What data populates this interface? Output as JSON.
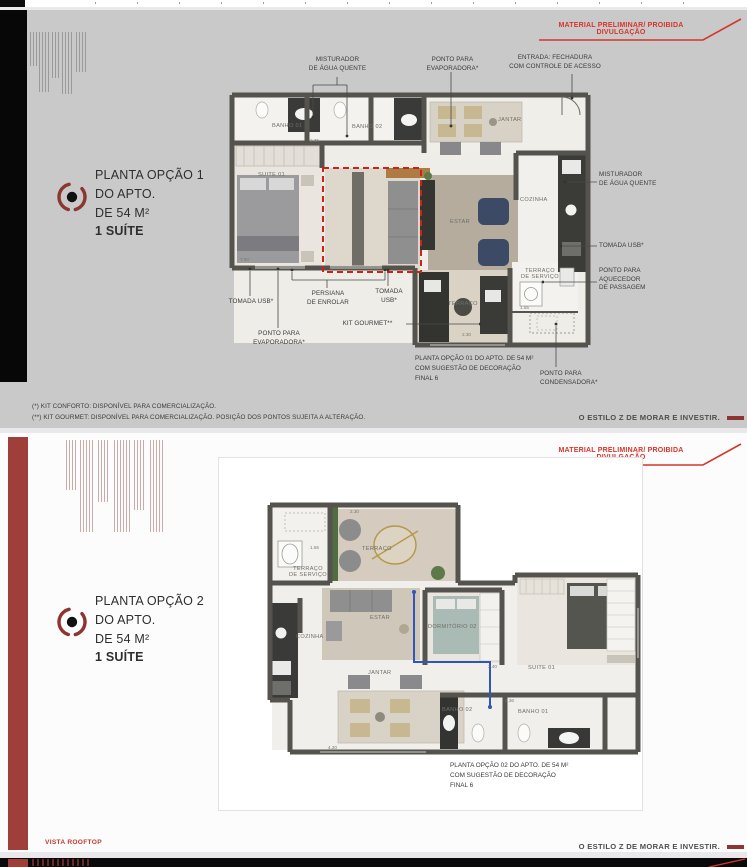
{
  "banner": "MATERIAL PRELIMINAR/ PROIBIDA DIVULGAÇÃO",
  "tagline": "O ESTILO Z DE MORAR E INVESTIR.",
  "colors": {
    "accent": "#8c3531",
    "banner_red": "#d6352c",
    "page1_bg": "#c9c9c9",
    "dashed_red": "#cc2218",
    "pipe_blue": "#3056b8"
  },
  "page1": {
    "title": {
      "l1": "PLANTA OPÇÃO 1",
      "l2": "DO APTO.",
      "l3": "DE 54 M²",
      "l4": "1 SUÍTE"
    },
    "rooms": {
      "suite": "SUITE 01",
      "banho1": "BANHO 01",
      "banho2": "BANHO 02",
      "jantar": "JANTAR",
      "estar": "ESTAR",
      "cozinha": "COZINHA",
      "terraco": "TERRAÇO",
      "terraco_servico": "TERRAÇO\nDE SERVIÇO"
    },
    "callouts": {
      "misturador_top": "MISTURADOR\nDE ÁGUA QUENTE",
      "evaporadora_top": "PONTO PARA\nEVAPORADORA*",
      "entrada": "ENTRADA: FECHADURA\nCOM CONTROLE DE ACESSO",
      "misturador_right": "MISTURADOR\nDE ÁGUA QUENTE",
      "tomada_right": "TOMADA USB*",
      "aquecedor": "PONTO PARA\nAQUECEDOR\nDE PASSAGEM",
      "tomada_bottom_left": "TOMADA USB*",
      "persiana": "PERSIANA\nDE ENROLAR",
      "tomada_bottom_center": "TOMADA\nUSB*",
      "kit_gourmet": "KIT GOURMET**",
      "evaporadora_bottom": "PONTO PARA\nEVAPORADORA*",
      "condensadora": "PONTO PARA\nCONDENSADORA*"
    },
    "caption": "PLANTA OPÇÃO 01 DO APTO. DE 54 M²\nCOM SUGESTÃO DE DECORAÇÃO\nFINAL 6",
    "footnote1": "(*) KIT CONFORTO: DISPONÍVEL PARA COMERCIALIZAÇÃO.",
    "footnote2": "(**) KIT GOURMET: DISPONÍVEL PARA COMERCIALIZAÇÃO. POSIÇÃO DOS PONTOS SUJEITA A ALTERAÇÃO.",
    "dims": [
      "2.36",
      "2.30",
      "1.55",
      "7.90"
    ]
  },
  "page2": {
    "title": {
      "l1": "PLANTA OPÇÃO 2",
      "l2": "DO APTO.",
      "l3": "DE 54 M²",
      "l4": "1 SUÍTE"
    },
    "rooms": {
      "terraco": "TERRAÇO",
      "terraco_servico": "TERRAÇO\nDE SERVIÇO",
      "estar": "ESTAR",
      "dormitorio2": "DORMITÓRIO 02",
      "cozinha": "COZINHA",
      "jantar": "JANTAR",
      "suite": "SUITE 01",
      "banho2": "BANHO 02",
      "banho1": "BANHO 01"
    },
    "caption": "PLANTA OPÇÃO 02 DO APTO. DE 54 M²\nCOM SUGESTÃO DE DECORAÇÃO\nFINAL 6",
    "vista_rooftop": "VISTA ROOFTOP",
    "dims": [
      "2.30",
      "1.55",
      "2.40",
      "2.36",
      "4.20"
    ]
  }
}
